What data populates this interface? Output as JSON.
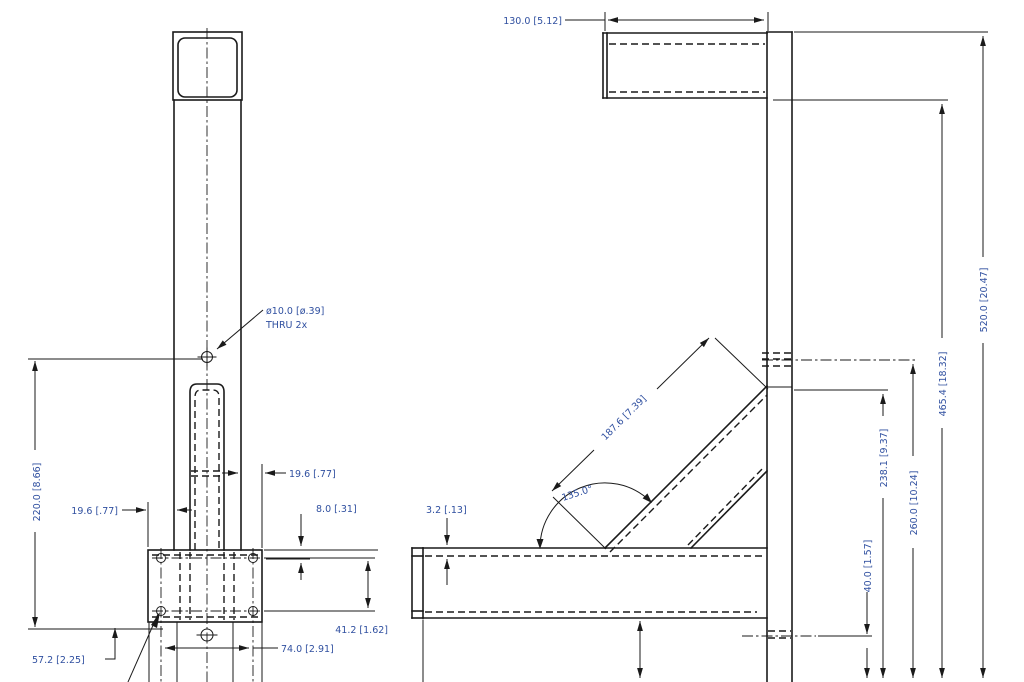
{
  "drawing": {
    "title": "bracket-two-view-engineering-drawing",
    "left_view": {
      "hole_callout_line1": "ø10.0 [ø.39]",
      "hole_callout_line2": "THRU 2x",
      "dim_height": "220.0 [8.66]",
      "dim_offset_left": "19.6 [.77]",
      "dim_offset_right": "19.6 [.77]",
      "dim_hole_to_edge": "8.0 [.31]",
      "dim_hole_spacing_vertical": "41.2 [1.62]",
      "dim_hole_spacing_horizontal": "74.0 [2.91]",
      "dim_base_height": "57.2 [2.25]"
    },
    "right_view": {
      "dim_top_arm_length": "130.0 [5.12]",
      "dim_wall_thickness": "3.2 [.13]",
      "dim_brace_length": "187.6 [7.39]",
      "dim_brace_angle": "135.0°",
      "dim_height_238": "238.1 [9.37]",
      "dim_height_260": "260.0 [10.24]",
      "dim_height_40": "40.0 [1.57]",
      "dim_height_465": "465.4 [18.32]",
      "dim_height_520": "520.0 [20.47]"
    },
    "colors": {
      "line": "#1a1a1a",
      "dim_text": "#3050a0",
      "background": "#ffffff"
    }
  }
}
